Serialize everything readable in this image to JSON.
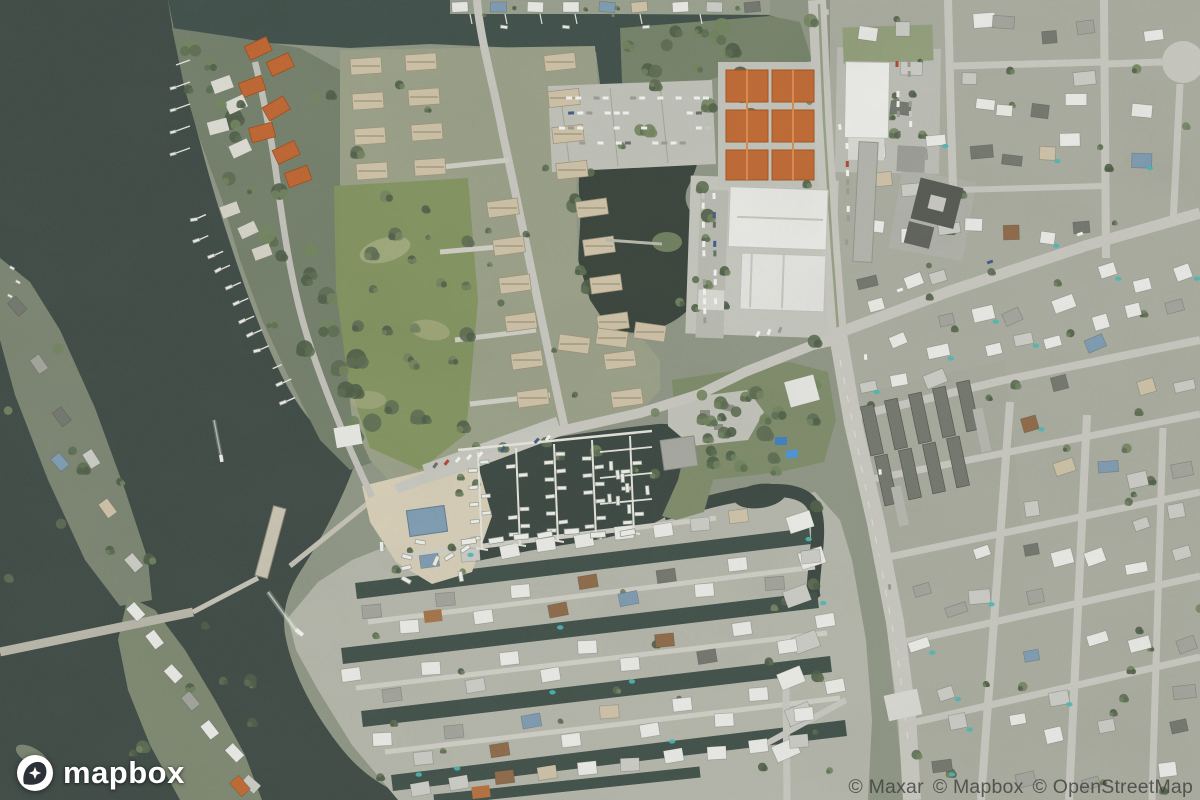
{
  "map": {
    "palette": {
      "water": "#3f4b46",
      "lake": "#39443b",
      "land": "#8f9685",
      "residential": "#a9ac9f",
      "fingers": "#b4b6aa",
      "dev": "#9aa088",
      "grass": "#82945e",
      "grassBare": "#a8ad82",
      "treeDark": "#4f5e48",
      "treeMid": "#5d6d52",
      "treeLight": "#72855f",
      "sand": "#d6ceb6",
      "road": "#c8c8c0",
      "roadMinor": "#cfcfc6",
      "bridge": "#b9b7a9",
      "paving": "#c0c1b8",
      "roofWhite": "#e9eae5",
      "roofLight": "#cbccc6",
      "roofGray": "#a3a59d",
      "roofDark": "#73776e",
      "roofTan": "#cec2a7",
      "roofOrange": "#c06a33",
      "roofBrown": "#8f6b49",
      "roofBlue": "#7e9cb2",
      "pool": "#4ab8b4",
      "boat": "#eeeee8",
      "dock": "#e4e4da"
    }
  },
  "logo": {
    "wordmark": "mapbox"
  },
  "attribution": {
    "items": [
      "© Maxar",
      "© Mapbox",
      "© OpenStreetMap"
    ]
  }
}
